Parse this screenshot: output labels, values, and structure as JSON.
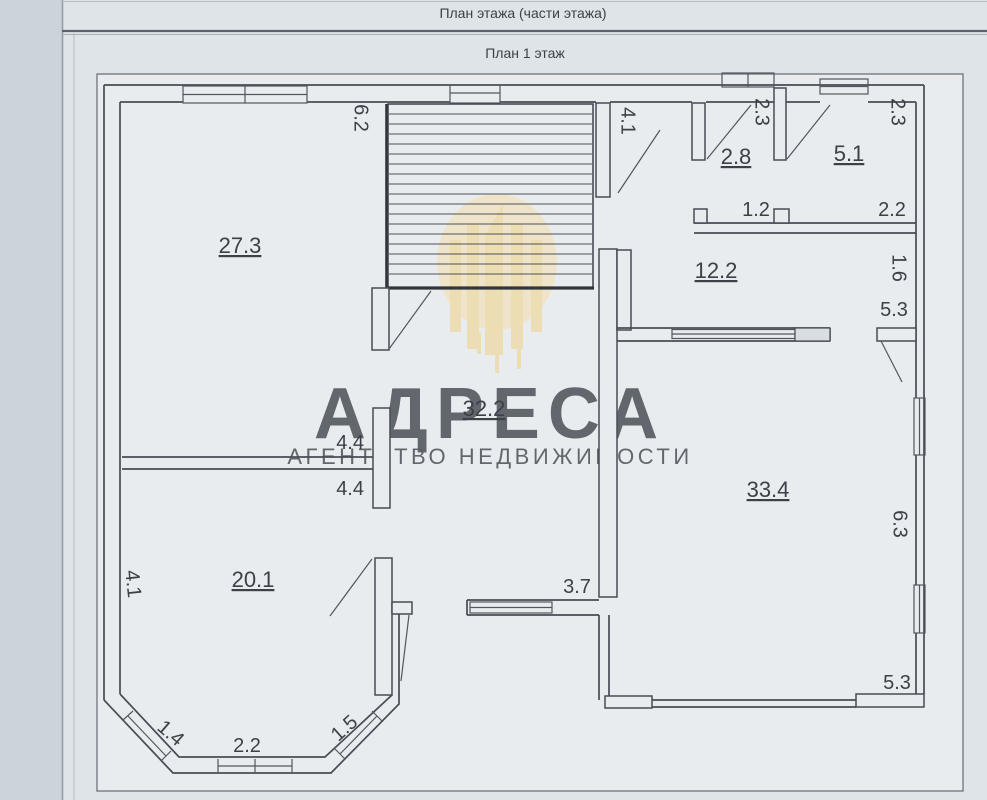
{
  "header": {
    "title": "План этажа (части этажа)",
    "subtitle": "План 1 этаж"
  },
  "watermark": {
    "brand": "АДРЕСА",
    "tagline": "АГЕНТСТВО НЕДВИЖИМОСТИ",
    "color": "#f0dcab"
  },
  "colors": {
    "paper": "#e8ecef",
    "page": "#dfe4e9",
    "line": "#474d54",
    "text": "#3b4147",
    "watermark_fill": "#f3e2ba",
    "watermark_bars": "#eed8a1"
  },
  "plan": {
    "room_27_3": "27.3",
    "room_2_8": "2.8",
    "room_5_1": "5.1",
    "room_12_2": "12.2",
    "room_32_2": "32.2",
    "room_33_4": "33.4",
    "room_20_1": "20.1",
    "dim_6_2": "6.2",
    "dim_4_1_hall": "4.1",
    "dim_2_3_a": "2.3",
    "dim_2_3_b": "2.3",
    "dim_1_2": "1.2",
    "dim_2_2_top": "2.2",
    "dim_1_6": "1.6",
    "dim_5_3_top": "5.3",
    "dim_4_4_a": "4.4",
    "dim_4_4_b": "4.4",
    "dim_6_3": "6.3",
    "dim_3_7": "3.7",
    "dim_4_1_left": "4.1",
    "dim_1_4": "1.4",
    "dim_2_2_bay": "2.2",
    "dim_1_5": "1.5",
    "dim_5_3_bottom": "5.3"
  }
}
